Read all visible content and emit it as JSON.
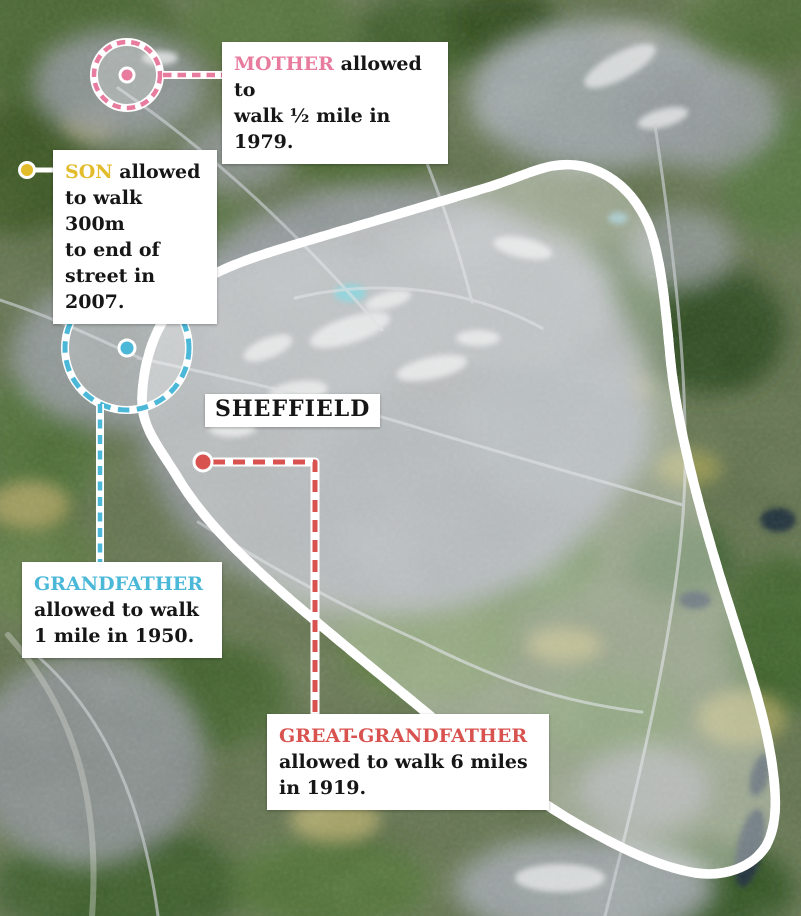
{
  "map": {
    "place_label": "SHEFFIELD"
  },
  "annotations": {
    "mother": {
      "name": "MOTHER",
      "text": "allowed to\nwalk ½ mile in 1979.",
      "color": "#e87c9e"
    },
    "son": {
      "name": "SON",
      "text": "allowed\nto walk 300m\nto end of\nstreet in 2007.",
      "color": "#e3bc2b"
    },
    "grandfather": {
      "name": "GRANDFATHER",
      "text": "\nallowed to walk\n1 mile in 1950.",
      "color": "#4cb8d8"
    },
    "great_grandfather": {
      "name": "GREAT-GRANDFATHER",
      "text": "\nallowed to walk 6 miles\nin 1919.",
      "color": "#d8534f"
    }
  }
}
